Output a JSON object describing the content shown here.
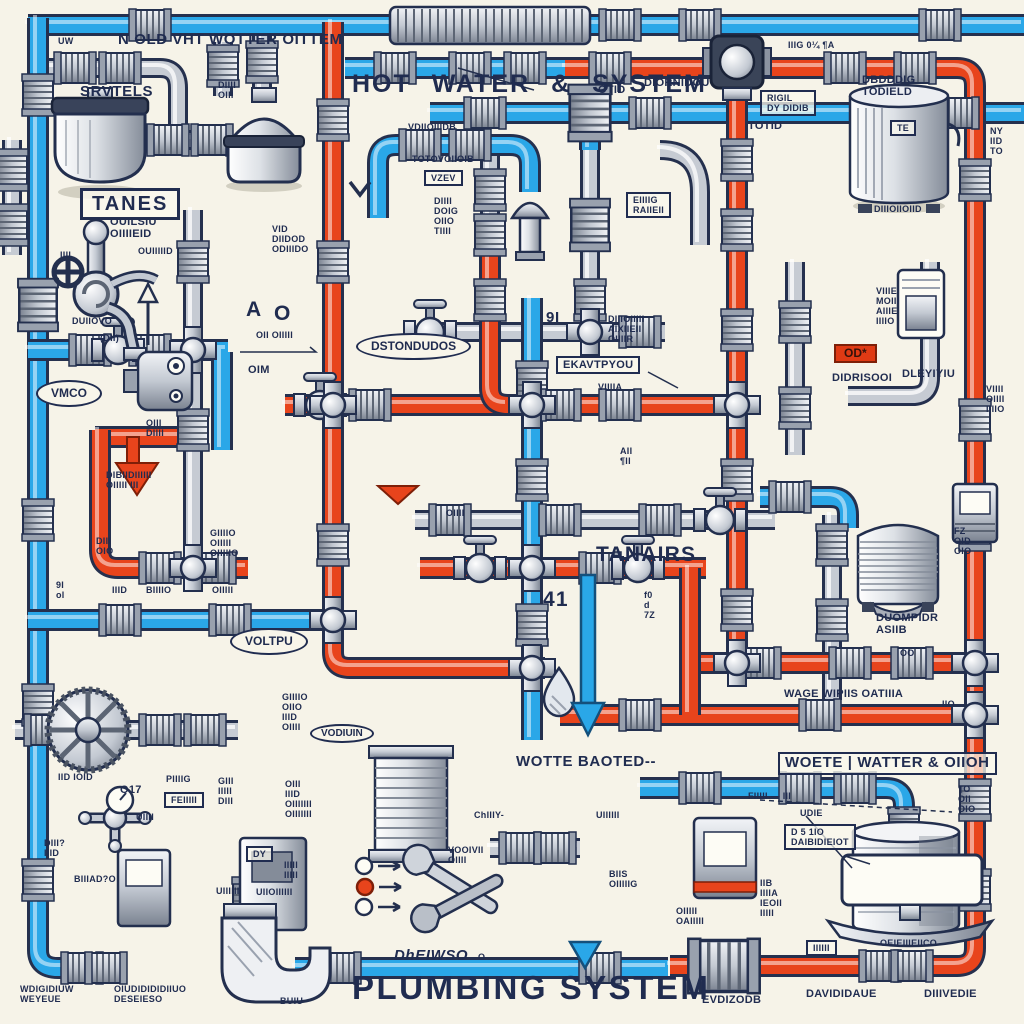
{
  "scene": {
    "background": "#f6f3e8",
    "ink": "#202c50",
    "cold_pipe_color": "#2aa7e8",
    "hot_pipe_color": "#e8441c",
    "gray_pipe_color": "#c6cbd3"
  },
  "legend": {
    "dot_colors": [
      "#fdfcf5",
      "#e8441c",
      "#fdfcf5"
    ]
  },
  "labels": [
    {
      "t": "UW",
      "x": 58,
      "y": 36,
      "s": "tiny"
    },
    {
      "t": "N OLD VHT WOTTER OITTEM",
      "x": 118,
      "y": 32,
      "s": "med",
      "n": "title-cold-water-system"
    },
    {
      "t": "HOT WATER & SYSTEM",
      "x": 352,
      "y": 70,
      "s": "title",
      "n": "title-hot-water-system"
    },
    {
      "t": "OTID",
      "x": 598,
      "y": 84,
      "s": "small"
    },
    {
      "t": "-DIORNIDOU",
      "x": 640,
      "y": 77,
      "s": "small"
    },
    {
      "t": "IIIG   0¼   ¶A",
      "x": 788,
      "y": 40,
      "s": "tiny"
    },
    {
      "t": "SRVTELS",
      "x": 80,
      "y": 84,
      "s": "med",
      "n": "label-tank-left"
    },
    {
      "t": "DIIII\nOIII",
      "x": 218,
      "y": 80,
      "s": "tiny"
    },
    {
      "t": "RIGIL\nDY DIDIB",
      "x": 760,
      "y": 90,
      "s": "box tiny"
    },
    {
      "t": "DBDDDIG\nTODIELD",
      "x": 862,
      "y": 74,
      "s": "small",
      "n": "label-tank-right"
    },
    {
      "t": "TE",
      "x": 890,
      "y": 120,
      "s": "box tiny"
    },
    {
      "t": "NY\nIID\nTO",
      "x": 990,
      "y": 126,
      "s": "tiny"
    },
    {
      "t": "VDIIOIIIDB",
      "x": 408,
      "y": 122,
      "s": "tiny"
    },
    {
      "t": "TOTOVOIIOIB",
      "x": 412,
      "y": 154,
      "s": "tiny"
    },
    {
      "t": "VZEV",
      "x": 424,
      "y": 170,
      "s": "box tiny"
    },
    {
      "t": "TOTID",
      "x": 748,
      "y": 120,
      "s": "small"
    },
    {
      "t": "DIIII\nDOIG\nOIIO\nTIIII",
      "x": 434,
      "y": 196,
      "s": "tiny"
    },
    {
      "t": "EIIIIG\nRAIIEII",
      "x": 626,
      "y": 192,
      "s": "box tiny"
    },
    {
      "t": "VID\nDIIDOD\nODIIIDO",
      "x": 272,
      "y": 224,
      "s": "tiny"
    },
    {
      "t": "TANES",
      "x": 80,
      "y": 188,
      "s": "boxbig",
      "n": "label-tanks-box"
    },
    {
      "t": "OUILSIU\nOIIIIEID",
      "x": 110,
      "y": 216,
      "s": "small"
    },
    {
      "t": "OUIIIIID",
      "x": 138,
      "y": 246,
      "s": "tiny"
    },
    {
      "t": "IIII",
      "x": 60,
      "y": 250,
      "s": "tiny"
    },
    {
      "t": "DUIIOVO",
      "x": 72,
      "y": 316,
      "s": "tiny"
    },
    {
      "t": "(DII)",
      "x": 100,
      "y": 333,
      "s": "tiny"
    },
    {
      "t": "A",
      "x": 246,
      "y": 298,
      "s": "big"
    },
    {
      "t": "O",
      "x": 274,
      "y": 302,
      "s": "big"
    },
    {
      "t": "OII OIIIII",
      "x": 256,
      "y": 330,
      "s": "tiny"
    },
    {
      "t": "OIM",
      "x": 248,
      "y": 364,
      "s": "small"
    },
    {
      "t": "VMCO",
      "x": 36,
      "y": 380,
      "s": "oval",
      "n": "oval-vmco"
    },
    {
      "t": "DSTONDUDOS",
      "x": 356,
      "y": 333,
      "s": "oval",
      "n": "oval-distribution"
    },
    {
      "t": "9I",
      "x": 546,
      "y": 310,
      "s": "med"
    },
    {
      "t": "DIIIOIIIII\nAIXIIEII\nOIIIIR",
      "x": 608,
      "y": 314,
      "s": "tiny"
    },
    {
      "t": "EKAVTPYOU",
      "x": 556,
      "y": 356,
      "s": "box small",
      "n": "label-expansion"
    },
    {
      "t": "VIIIIA",
      "x": 598,
      "y": 382,
      "s": "tiny"
    },
    {
      "t": "OD*",
      "x": 834,
      "y": 344,
      "s": "redbox",
      "n": "red-tag"
    },
    {
      "t": "DIDRISOOI",
      "x": 832,
      "y": 372,
      "s": "small"
    },
    {
      "t": "DLEYIYIU",
      "x": 902,
      "y": 368,
      "s": "small"
    },
    {
      "t": "DIIIOIIOIID",
      "x": 874,
      "y": 204,
      "s": "tiny"
    },
    {
      "t": "VIIIE\nMOIII\nAIIIE\nIIIIO",
      "x": 876,
      "y": 286,
      "s": "tiny"
    },
    {
      "t": "VIIII\nOIIII\nIIIIO",
      "x": 986,
      "y": 384,
      "s": "tiny"
    },
    {
      "t": "OIII\nDIIII",
      "x": 146,
      "y": 418,
      "s": "tiny"
    },
    {
      "t": "DIBIIDIIIIII\nOIIIII III",
      "x": 106,
      "y": 470,
      "s": "tiny"
    },
    {
      "t": "OIIII",
      "x": 446,
      "y": 508,
      "s": "tiny"
    },
    {
      "t": "AII\n¶II",
      "x": 620,
      "y": 446,
      "s": "tiny"
    },
    {
      "t": "DIII\nOIO",
      "x": 96,
      "y": 536,
      "s": "tiny"
    },
    {
      "t": "9I\nol",
      "x": 56,
      "y": 580,
      "s": "tiny"
    },
    {
      "t": "IIID",
      "x": 112,
      "y": 585,
      "s": "tiny"
    },
    {
      "t": "BIIIIO",
      "x": 146,
      "y": 585,
      "s": "tiny"
    },
    {
      "t": "GIIIIO\nOIIIII\nOIIIIIO",
      "x": 210,
      "y": 528,
      "s": "tiny"
    },
    {
      "t": "OIIIII",
      "x": 212,
      "y": 585,
      "s": "tiny"
    },
    {
      "t": "VOLTPU",
      "x": 230,
      "y": 628,
      "s": "oval",
      "n": "oval-venturi"
    },
    {
      "t": "TANAIRS",
      "x": 596,
      "y": 543,
      "s": "big",
      "n": "label-tanks-mid"
    },
    {
      "t": "41",
      "x": 543,
      "y": 588,
      "s": "big",
      "n": "label-41"
    },
    {
      "t": "f0\nd\n7Z",
      "x": 644,
      "y": 590,
      "s": "tiny"
    },
    {
      "t": "DUOMPIDR\nASIIB",
      "x": 876,
      "y": 612,
      "s": "small",
      "n": "label-diverter"
    },
    {
      "t": "OO",
      "x": 900,
      "y": 648,
      "s": "tiny"
    },
    {
      "t": "FZ\nOID\nOIO",
      "x": 954,
      "y": 526,
      "s": "tiny"
    },
    {
      "t": "WAGE WIPIIS OATIIIA",
      "x": 784,
      "y": 688,
      "s": "small",
      "n": "label-waste-water-small"
    },
    {
      "t": "IIO",
      "x": 942,
      "y": 699,
      "s": "tiny"
    },
    {
      "t": "GIIIIO\nOIIO\nIIID\nOIIII",
      "x": 282,
      "y": 692,
      "s": "tiny"
    },
    {
      "t": "VODIUIN",
      "x": 310,
      "y": 724,
      "s": "ovsm",
      "n": "oval-vodium"
    },
    {
      "t": "WOTTE BAOTED--",
      "x": 516,
      "y": 754,
      "s": "med",
      "n": "label-waste-water-left"
    },
    {
      "t": "WOETE | WATTER & OIIOH",
      "x": 778,
      "y": 752,
      "s": "box med",
      "n": "label-waste-water-box"
    },
    {
      "t": "IID IOID",
      "x": 58,
      "y": 772,
      "s": "tiny"
    },
    {
      "t": "O17",
      "x": 120,
      "y": 784,
      "s": "small"
    },
    {
      "t": "PIIIIG",
      "x": 166,
      "y": 774,
      "s": "tiny"
    },
    {
      "t": "FEIIIII",
      "x": 164,
      "y": 792,
      "s": "box tiny"
    },
    {
      "t": "GIII\nIIIII\nDIII",
      "x": 218,
      "y": 776,
      "s": "tiny"
    },
    {
      "t": "OIII\nIIID\nOIIIIIII\nOIIIIIII",
      "x": 285,
      "y": 779,
      "s": "tiny"
    },
    {
      "t": "UIIII",
      "x": 136,
      "y": 812,
      "s": "tiny"
    },
    {
      "t": "DIII?\nIIID",
      "x": 44,
      "y": 838,
      "s": "tiny"
    },
    {
      "t": "BIIIAD?O",
      "x": 74,
      "y": 874,
      "s": "tiny"
    },
    {
      "t": "DY",
      "x": 246,
      "y": 846,
      "s": "box tiny"
    },
    {
      "t": "UIIIIII",
      "x": 216,
      "y": 886,
      "s": "tiny"
    },
    {
      "t": "UIIOIIIIII",
      "x": 256,
      "y": 887,
      "s": "tiny"
    },
    {
      "t": "IIIII\nIIIII",
      "x": 284,
      "y": 860,
      "s": "tiny"
    },
    {
      "t": "ChIIIY-",
      "x": 474,
      "y": 810,
      "s": "tiny"
    },
    {
      "t": "VOOIVII\nOIIII",
      "x": 448,
      "y": 845,
      "s": "tiny"
    },
    {
      "t": "DhEIWSO",
      "x": 394,
      "y": 948,
      "s": "med italic"
    },
    {
      "t": "O",
      "x": 478,
      "y": 952,
      "s": "tiny"
    },
    {
      "t": "WDIGIDIUW\nWEYEUE",
      "x": 20,
      "y": 984,
      "s": "tiny"
    },
    {
      "t": "OIUDIDIDIDIIUO\nDESEIESO",
      "x": 114,
      "y": 984,
      "s": "tiny"
    },
    {
      "t": "BUIU",
      "x": 280,
      "y": 996,
      "s": "tiny"
    },
    {
      "t": "PLUMBING SYSTEM",
      "x": 352,
      "y": 970,
      "s": "mega",
      "n": "title-plumbing-system"
    },
    {
      "t": "EVDIZODB",
      "x": 702,
      "y": 994,
      "s": "small"
    },
    {
      "t": "DAVIDIDAUE",
      "x": 806,
      "y": 988,
      "s": "small"
    },
    {
      "t": "DIIIVEDIE",
      "x": 924,
      "y": 988,
      "s": "small"
    },
    {
      "t": "FIIIII — III",
      "x": 748,
      "y": 791,
      "s": "tiny"
    },
    {
      "t": "UDIE",
      "x": 800,
      "y": 808,
      "s": "tiny"
    },
    {
      "t": "D 5 1IO\nDAIBIDIEIOT",
      "x": 784,
      "y": 824,
      "s": "box tiny"
    },
    {
      "t": "IIB\nIIIIA\nIEOII\nIIIII",
      "x": 760,
      "y": 878,
      "s": "tiny"
    },
    {
      "t": "UIIIIII",
      "x": 596,
      "y": 810,
      "s": "tiny"
    },
    {
      "t": "BIIS\nOIIIIIG",
      "x": 609,
      "y": 869,
      "s": "tiny"
    },
    {
      "t": "OIIIII\nOAIIIII",
      "x": 676,
      "y": 906,
      "s": "tiny"
    },
    {
      "t": "IIIIII",
      "x": 806,
      "y": 940,
      "s": "box tiny"
    },
    {
      "t": "OEIEIIIEIICO",
      "x": 880,
      "y": 938,
      "s": "tiny",
      "n": "label-water-heater"
    },
    {
      "t": "¶O\nOII\nOIO",
      "x": 958,
      "y": 784,
      "s": "tiny"
    }
  ]
}
